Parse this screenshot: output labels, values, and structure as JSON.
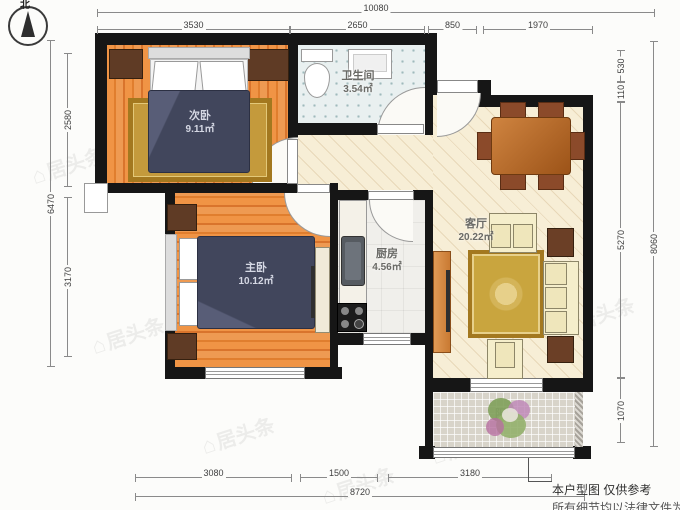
{
  "compass": {
    "label": "北"
  },
  "watermark": {
    "icon": "⌂",
    "text": "居头条"
  },
  "rooms": {
    "bedroom2": {
      "name": "次卧",
      "area": "9.11㎡"
    },
    "bathroom": {
      "name": "卫生间",
      "area": "3.54㎡"
    },
    "master_bedroom": {
      "name": "主卧",
      "area": "10.12㎡"
    },
    "kitchen": {
      "name": "厨房",
      "area": "4.56㎡"
    },
    "living_room": {
      "name": "客厅",
      "area": "20.22㎡"
    },
    "balcony": {
      "name": "阳台"
    }
  },
  "dimensions": {
    "top": {
      "total": "10080",
      "segments": [
        "3530",
        "2650",
        "850",
        "1970"
      ]
    },
    "left": {
      "total": "6470",
      "segments": [
        "2580",
        "3170"
      ]
    },
    "right": {
      "total": "8060",
      "segments": [
        "530",
        "110",
        "5270",
        "1070"
      ]
    },
    "bottom": {
      "total": "8720",
      "segments": [
        "3080",
        "1500",
        "3180"
      ]
    }
  },
  "disclaimer": {
    "line1": "本户型图 仅供参考",
    "line2": "所有细节均以法律文件为准"
  },
  "palette": {
    "wall": "#161616",
    "wood": "#e8863b",
    "bed": "#41465c",
    "bath_tile": "#e9f0f0",
    "hall_floor": "#f7eed6",
    "rug_gold": "#c9a23f",
    "balcony_tile": "#d8d4ca"
  }
}
